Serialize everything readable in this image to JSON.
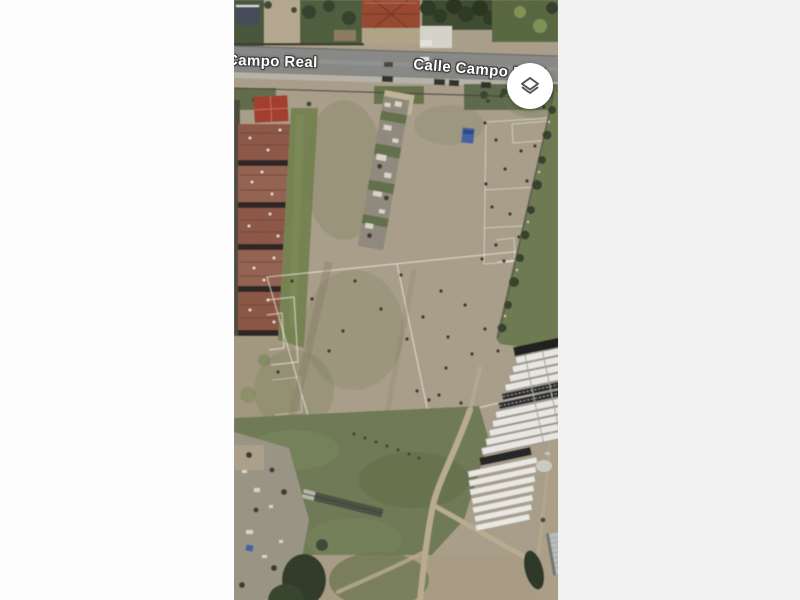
{
  "app": {
    "view": "satellite-map",
    "description": "Aerial satellite view of a dirt sports field bordered by Calle Campo Real, apartment blocks and market stall rows"
  },
  "map": {
    "street_labels": {
      "left": "Campo Real",
      "right": "Calle Campo Real"
    },
    "controls": {
      "layers_button": {
        "icon": "layers-icon",
        "shape": "circle",
        "background": "#ffffff",
        "icon_color": "#575757"
      }
    },
    "palette": {
      "page_left": "#fdfdfd",
      "page_right": "#f1f1f1",
      "label_text": "#ffffff",
      "label_halo": "#3c3c3c",
      "button_bg": "#ffffff",
      "icon_color": "#575757",
      "road": "#878785",
      "sidewalk": "#b6b2a8",
      "field_tan": "#a89d89",
      "grass_green": "#6f7a53",
      "roof_red": "#96452f",
      "apartment_roof": "#8c5544",
      "stall_white": "#e9e8e4",
      "stall_dark": "#1e1e1c",
      "rubble_gray": "#9b968b",
      "path_tan": "#b9ab8e",
      "tarp_blue": "#3f5fa3",
      "warehouse_gray": "#b9bdb9"
    },
    "people_dots": [
      [
        254,
        101
      ],
      [
        267,
        96
      ],
      [
        282,
        92
      ],
      [
        296,
        99
      ],
      [
        310,
        107
      ],
      [
        251,
        123
      ],
      [
        262,
        140
      ],
      [
        287,
        151
      ],
      [
        301,
        146
      ],
      [
        271,
        169
      ],
      [
        252,
        184
      ],
      [
        293,
        181
      ],
      [
        311,
        177
      ],
      [
        258,
        207
      ],
      [
        276,
        214
      ],
      [
        299,
        204
      ],
      [
        313,
        221
      ],
      [
        262,
        245
      ],
      [
        285,
        237
      ],
      [
        305,
        251
      ],
      [
        248,
        259
      ],
      [
        270,
        261
      ],
      [
        318,
        240
      ],
      [
        121,
        281
      ],
      [
        167,
        275
      ],
      [
        207,
        291
      ],
      [
        147,
        309
      ],
      [
        189,
        317
      ],
      [
        231,
        305
      ],
      [
        109,
        331
      ],
      [
        173,
        339
      ],
      [
        214,
        337
      ],
      [
        251,
        329
      ],
      [
        281,
        319
      ],
      [
        299,
        341
      ],
      [
        238,
        354
      ],
      [
        264,
        351
      ],
      [
        291,
        367
      ],
      [
        212,
        368
      ],
      [
        183,
        391
      ],
      [
        195,
        400
      ],
      [
        205,
        395
      ],
      [
        214,
        409
      ],
      [
        227,
        403
      ],
      [
        189,
        429
      ],
      [
        200,
        437
      ],
      [
        211,
        427
      ],
      [
        242,
        451
      ],
      [
        167,
        451
      ],
      [
        255,
        469
      ],
      [
        229,
        469
      ],
      [
        196,
        486
      ],
      [
        78,
        299
      ],
      [
        58,
        281
      ],
      [
        95,
        351
      ],
      [
        66,
        419
      ],
      [
        44,
        372
      ]
    ]
  }
}
